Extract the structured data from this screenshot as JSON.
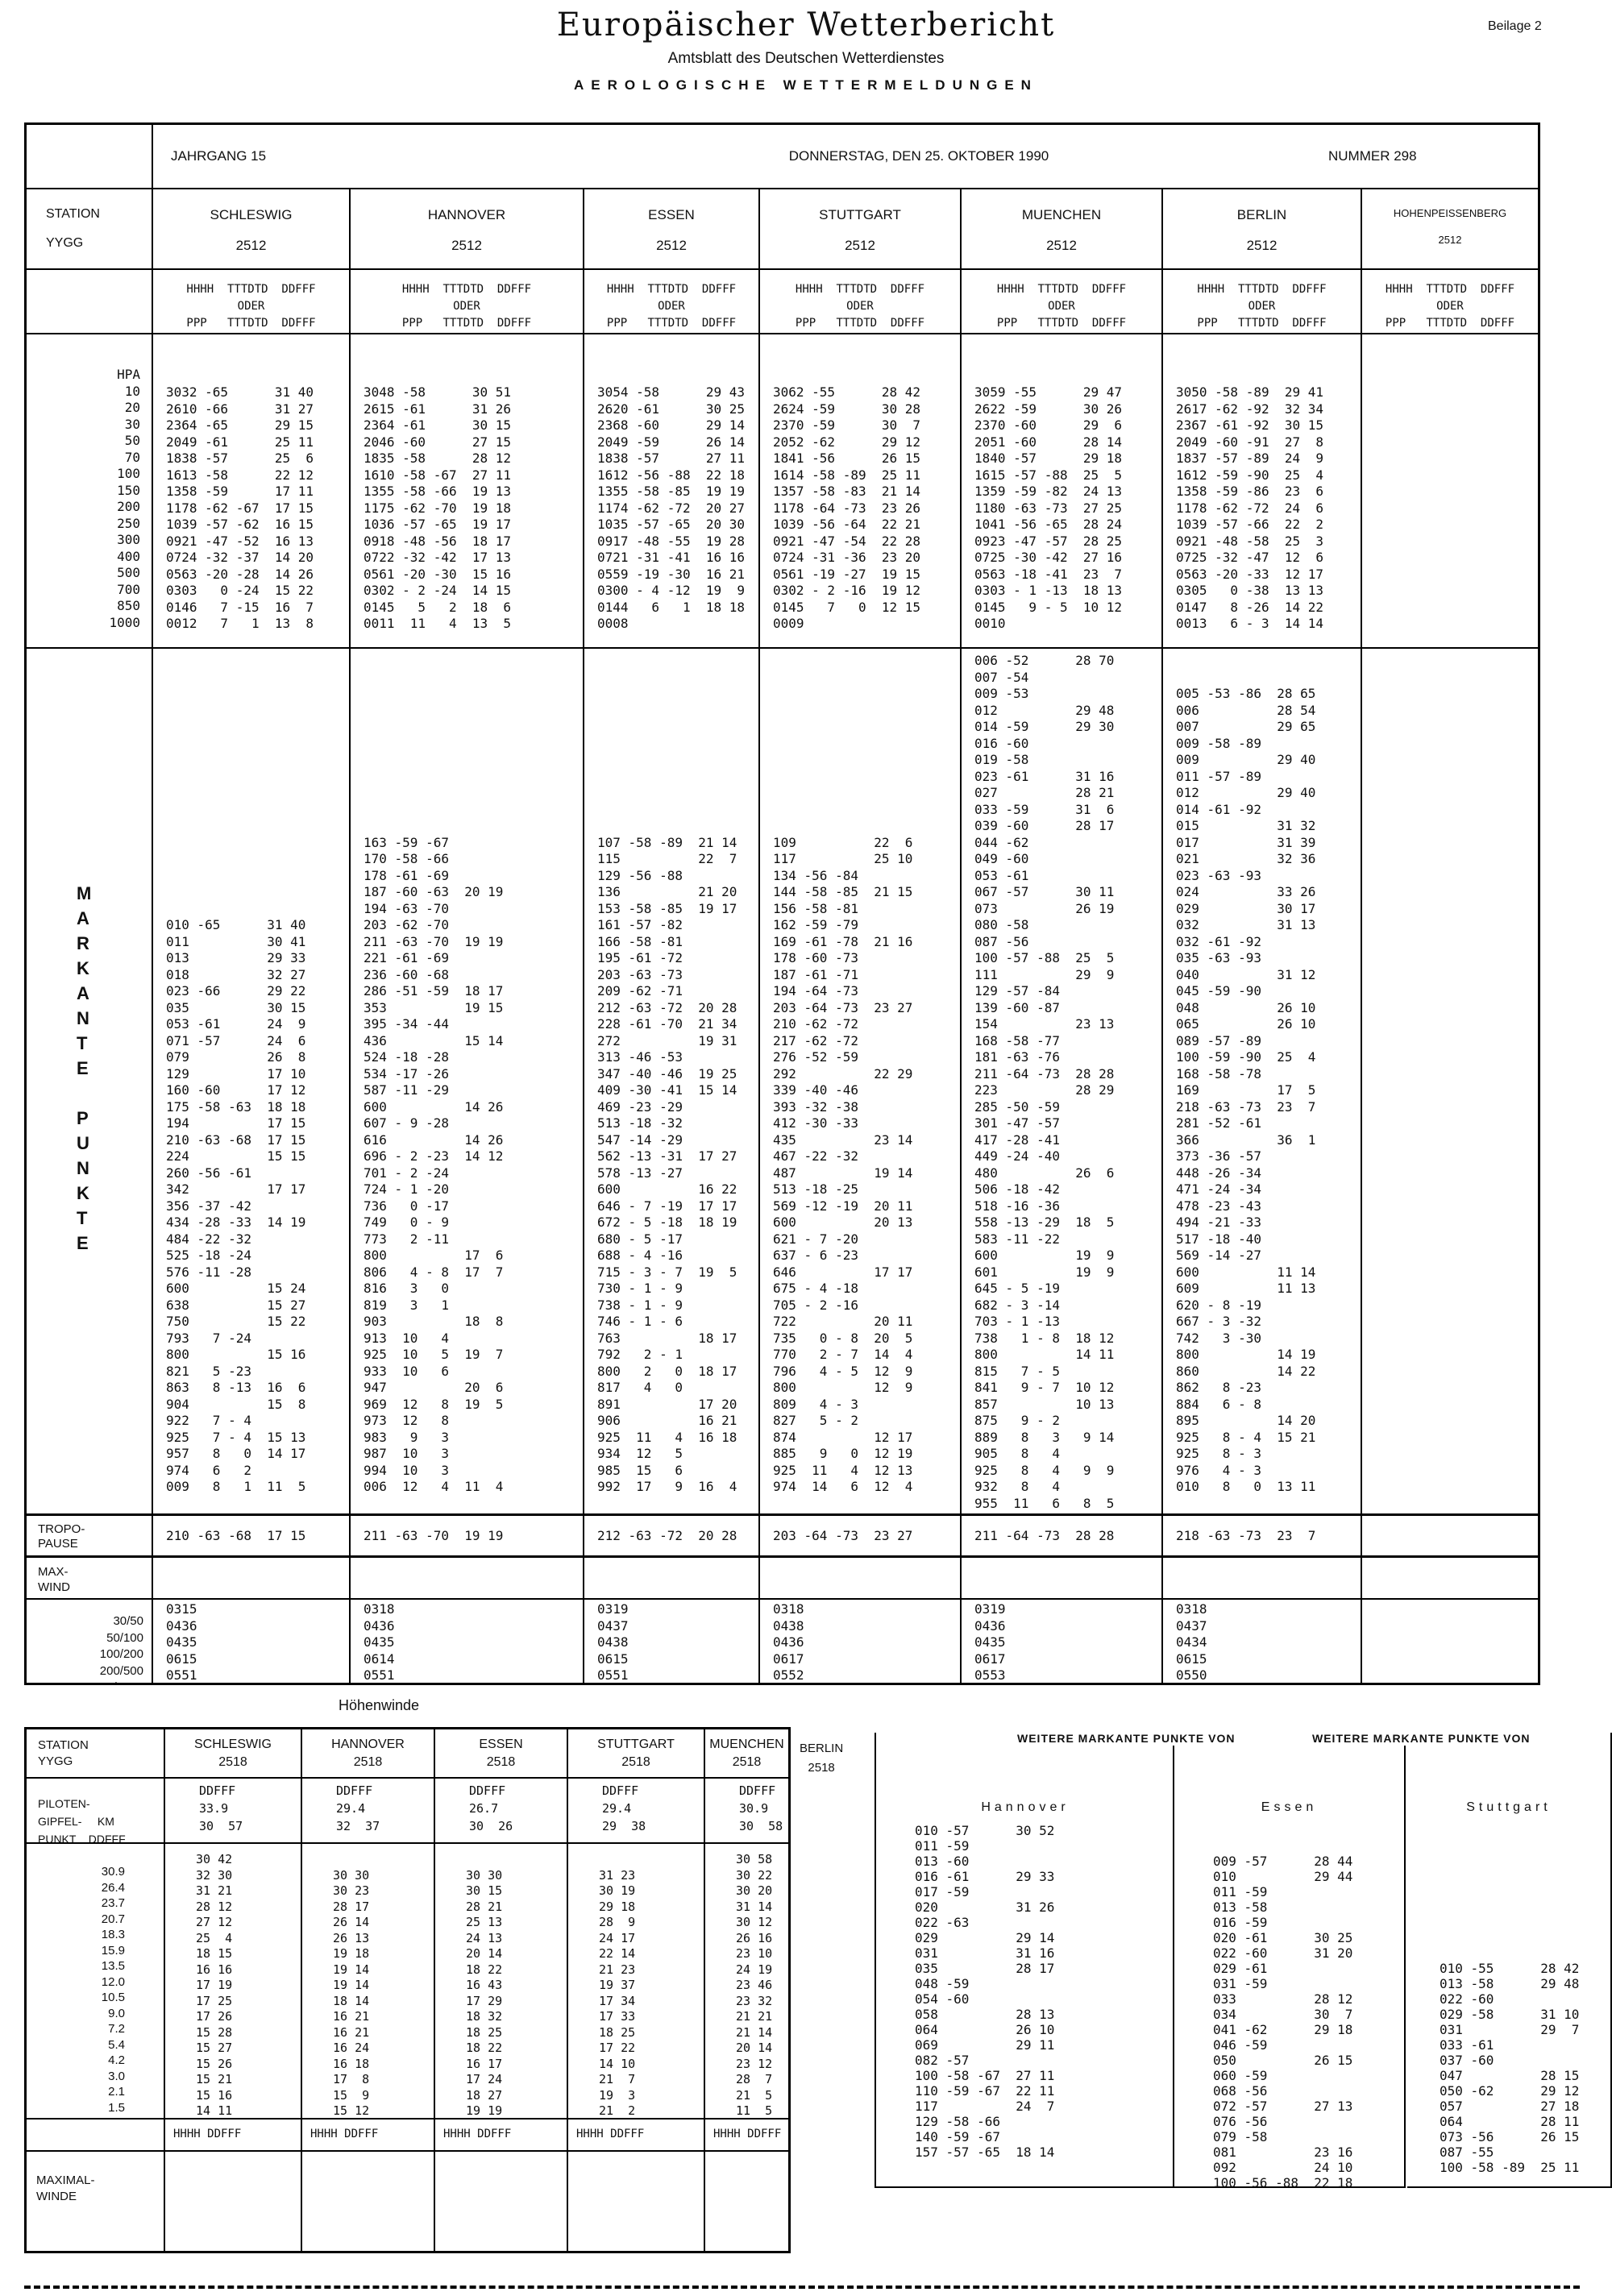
{
  "page": {
    "beilage": "Beilage 2",
    "title": "Europäischer Wetterbericht",
    "subtitle": "Amtsblatt des Deutschen Wetterdienstes",
    "tagline": "AEROLOGISCHE WETTERMELDUNGEN"
  },
  "issue": {
    "jahrgang": "JAHRGANG 15",
    "date": "DONNERSTAG, DEN 25. OKTOBER 1990",
    "nummer": "NUMMER 298"
  },
  "main_table": {
    "station_label": "STATION",
    "yygg_label": "YYGG",
    "hpa_label": "HPA",
    "codes": [
      "HHHH  TTTDTD  DDFFF",
      "ODER",
      "PPP   TTTDTD  DDFFF"
    ],
    "pressures": [
      "10",
      "20",
      "30",
      "50",
      "70",
      "100",
      "150",
      "200",
      "250",
      "300",
      "400",
      "500",
      "700",
      "850",
      "1000"
    ],
    "markante_label": [
      "M",
      "A",
      "R",
      "K",
      "A",
      "N",
      "T",
      "E",
      "",
      "P",
      "U",
      "N",
      "K",
      "T",
      "E"
    ],
    "tropo_label": [
      "TROPO-",
      "PAUSE"
    ],
    "maxwind_label": [
      "MAX-",
      "WIND"
    ],
    "maxwind_layers": [
      "30/50",
      "50/100",
      "100/200",
      "200/500",
      "500/1000"
    ],
    "stations": [
      {
        "name": "SCHLESWIG",
        "yygg": "2512",
        "hpa": [
          "3032 -65      31 40",
          "2610 -66      31 27",
          "2364 -65      29 15",
          "2049 -61      25 11",
          "1838 -57      25  6",
          "1613 -58      22 12",
          "1358 -59      17 11",
          "1178 -62 -67  17 15",
          "1039 -57 -62  16 15",
          "0921 -47 -52  16 13",
          "0724 -32 -37  14 20",
          "0563 -20 -28  14 26",
          "0303   0 -24  15 22",
          "0146   7 -15  16  7",
          "0012   7   1  13  8"
        ],
        "markante": [
          "",
          "",
          "",
          "",
          "",
          "",
          "",
          "",
          "",
          "",
          "",
          "",
          "",
          "",
          "",
          "",
          "010 -65      31 40",
          "011          30 41",
          "013          29 33",
          "018          32 27",
          "023 -66      29 22",
          "035          30 15",
          "053 -61      24  9",
          "071 -57      24  6",
          "079          26  8",
          "129          17 10",
          "160 -60      17 12",
          "175 -58 -63  18 18",
          "194          17 15",
          "210 -63 -68  17 15",
          "224          15 15",
          "260 -56 -61",
          "342          17 17",
          "356 -37 -42",
          "434 -28 -33  14 19",
          "484 -22 -32",
          "525 -18 -24",
          "576 -11 -28",
          "600          15 24",
          "638          15 27",
          "750          15 22",
          "793   7 -24",
          "800          15 16",
          "821   5 -23",
          "863   8 -13  16  6",
          "904          15  8",
          "922   7 - 4",
          "925   7 - 4  15 13",
          "957   8   0  14 17",
          "974   6   2",
          "009   8   1  11  5"
        ],
        "tropopause": "210 -63 -68  17 15",
        "maxwind": [
          "0315",
          "0436",
          "0435",
          "0615",
          "0551"
        ]
      },
      {
        "name": "HANNOVER",
        "yygg": "2512",
        "hpa": [
          "3048 -58      30 51",
          "2615 -61      31 26",
          "2364 -61      30 15",
          "2046 -60      27 15",
          "1835 -58      28 12",
          "1610 -58 -67  27 11",
          "1355 -58 -66  19 13",
          "1175 -62 -70  19 18",
          "1036 -57 -65  19 17",
          "0918 -48 -56  18 17",
          "0722 -32 -42  17 13",
          "0561 -20 -30  15 16",
          "0302 - 2 -24  14 15",
          "0145   5   2  18  6",
          "0011  11   4  13  5"
        ],
        "markante": [
          "",
          "",
          "",
          "",
          "",
          "",
          "",
          "",
          "",
          "",
          "",
          "163 -59 -67",
          "170 -58 -66",
          "178 -61 -69",
          "187 -60 -63  20 19",
          "194 -63 -70",
          "203 -62 -70",
          "211 -63 -70  19 19",
          "221 -61 -69",
          "236 -60 -68",
          "286 -51 -59  18 17",
          "353          19 15",
          "395 -34 -44",
          "436          15 14",
          "524 -18 -28",
          "534 -17 -26",
          "587 -11 -29",
          "600          14 26",
          "607 - 9 -28",
          "616          14 26",
          "696 - 2 -23  14 12",
          "701 - 2 -24",
          "724 - 1 -20",
          "736   0 -17",
          "749   0 - 9",
          "773   2 -11",
          "800          17  6",
          "806   4 - 8  17  7",
          "816   3   0",
          "819   3   1",
          "903          18  8",
          "913  10   4",
          "925  10   5  19  7",
          "933  10   6",
          "947          20  6",
          "969  12   8  19  5",
          "973  12   8",
          "983   9   3",
          "987  10   3",
          "994  10   3",
          "006  12   4  11  4"
        ],
        "tropopause": "211 -63 -70  19 19",
        "maxwind": [
          "0318",
          "0436",
          "0435",
          "0614",
          "0551"
        ]
      },
      {
        "name": "ESSEN",
        "yygg": "2512",
        "hpa": [
          "3054 -58      29 43",
          "2620 -61      30 25",
          "2368 -60      29 14",
          "2049 -59      26 14",
          "1838 -57      27 11",
          "1612 -56 -88  22 18",
          "1355 -58 -85  19 19",
          "1174 -62 -72  20 27",
          "1035 -57 -65  20 30",
          "0917 -48 -55  19 28",
          "0721 -31 -41  16 16",
          "0559 -19 -30  16 21",
          "0300 - 4 -12  19  9",
          "0144   6   1  18 18",
          "0008"
        ],
        "markante": [
          "",
          "",
          "",
          "",
          "",
          "",
          "",
          "",
          "",
          "",
          "",
          "107 -58 -89  21 14",
          "115          22  7",
          "129 -56 -88",
          "136          21 20",
          "153 -58 -85  19 17",
          "161 -57 -82",
          "166 -58 -81",
          "195 -61 -72",
          "203 -63 -73",
          "209 -62 -71",
          "212 -63 -72  20 28",
          "228 -61 -70  21 34",
          "272          19 31",
          "313 -46 -53",
          "347 -40 -46  19 25",
          "409 -30 -41  15 14",
          "469 -23 -29",
          "513 -18 -32",
          "547 -14 -29",
          "562 -13 -31  17 27",
          "578 -13 -27",
          "600          16 22",
          "646 - 7 -19  17 17",
          "672 - 5 -18  18 19",
          "680 - 5 -17",
          "688 - 4 -16",
          "715 - 3 - 7  19  5",
          "730 - 1 - 9",
          "738 - 1 - 9",
          "746 - 1 - 6",
          "763          18 17",
          "792   2 - 1",
          "800   2   0  18 17",
          "817   4   0",
          "891          17 20",
          "906          16 21",
          "925  11   4  16 18",
          "934  12   5",
          "985  15   6",
          "992  17   9  16  4"
        ],
        "tropopause": "212 -63 -72  20 28",
        "maxwind": [
          "0319",
          "0437",
          "0438",
          "0615",
          "0551"
        ]
      },
      {
        "name": "STUTTGART",
        "yygg": "2512",
        "hpa": [
          "3062 -55      28 42",
          "2624 -59      30 28",
          "2370 -59      30  7",
          "2052 -62      29 12",
          "1841 -56      26 15",
          "1614 -58 -89  25 11",
          "1357 -58 -83  21 14",
          "1178 -64 -73  23 26",
          "1039 -56 -64  22 21",
          "0921 -47 -54  22 28",
          "0724 -31 -36  23 20",
          "0561 -19 -27  19 15",
          "0302 - 2 -16  19 12",
          "0145   7   0  12 15",
          "0009"
        ],
        "markante": [
          "",
          "",
          "",
          "",
          "",
          "",
          "",
          "",
          "",
          "",
          "",
          "109          22  6",
          "117          25 10",
          "134 -56 -84",
          "144 -58 -85  21 15",
          "156 -58 -81",
          "162 -59 -79",
          "169 -61 -78  21 16",
          "178 -60 -73",
          "187 -61 -71",
          "194 -64 -73",
          "203 -64 -73  23 27",
          "210 -62 -72",
          "217 -62 -72",
          "276 -52 -59",
          "292          22 29",
          "339 -40 -46",
          "393 -32 -38",
          "412 -30 -33",
          "435          23 14",
          "467 -22 -32",
          "487          19 14",
          "513 -18 -25",
          "569 -12 -19  20 11",
          "600          20 13",
          "621 - 7 -20",
          "637 - 6 -23",
          "646          17 17",
          "675 - 4 -18",
          "705 - 2 -16",
          "722          20 11",
          "735   0 - 8  20  5",
          "770   2 - 7  14  4",
          "796   4 - 5  12  9",
          "800          12  9",
          "809   4 - 3",
          "827   5 - 2",
          "874          12 17",
          "885   9   0  12 19",
          "925  11   4  12 13",
          "974  14   6  12  4"
        ],
        "tropopause": "203 -64 -73  23 27",
        "maxwind": [
          "0318",
          "0438",
          "0436",
          "0617",
          "0552"
        ]
      },
      {
        "name": "MUENCHEN",
        "yygg": "2512",
        "hpa": [
          "3059 -55      29 47",
          "2622 -59      30 26",
          "2370 -60      29  6",
          "2051 -60      28 14",
          "1840 -57      29 18",
          "1615 -57 -88  25  5",
          "1359 -59 -82  24 13",
          "1180 -63 -73  27 25",
          "1041 -56 -65  28 24",
          "0923 -47 -57  28 25",
          "0725 -30 -42  27 16",
          "0563 -18 -41  23  7",
          "0303 - 1 -13  18 13",
          "0145   9 - 5  10 12",
          "0010"
        ],
        "markante": [
          "006 -52      28 70",
          "007 -54",
          "009 -53",
          "012          29 48",
          "014 -59      29 30",
          "016 -60",
          "019 -58",
          "023 -61      31 16",
          "027          28 21",
          "033 -59      31  6",
          "039 -60      28 17",
          "044 -62",
          "049 -60",
          "053 -61",
          "067 -57      30 11",
          "073          26 19",
          "080 -58",
          "087 -56",
          "100 -57 -88  25  5",
          "111          29  9",
          "129 -57 -84",
          "139 -60 -87",
          "154          23 13",
          "168 -58 -77",
          "181 -63 -76",
          "211 -64 -73  28 28",
          "223          28 29",
          "285 -50 -59",
          "301 -47 -57",
          "417 -28 -41",
          "449 -24 -40",
          "480          26  6",
          "506 -18 -42",
          "518 -16 -36",
          "558 -13 -29  18  5",
          "583 -11 -22",
          "600          19  9",
          "601          19  9",
          "645 - 5 -19",
          "682 - 3 -14",
          "703 - 1 -13",
          "738   1 - 8  18 12",
          "800          14 11",
          "815   7 - 5",
          "841   9 - 7  10 12",
          "857          10 13",
          "875   9 - 2",
          "889   8   3   9 14",
          "905   8   4",
          "925   8   4   9  9",
          "932   8   4",
          "955  11   6   8  5"
        ],
        "tropopause": "211 -64 -73  28 28",
        "maxwind": [
          "0319",
          "0436",
          "0435",
          "0617",
          "0553"
        ]
      },
      {
        "name": "BERLIN",
        "yygg": "2512",
        "hpa": [
          "3050 -58 -89  29 41",
          "2617 -62 -92  32 34",
          "2367 -61 -92  30 15",
          "2049 -60 -91  27  8",
          "1837 -57 -89  24  9",
          "1612 -59 -90  25  4",
          "1358 -59 -86  23  6",
          "1178 -62 -72  24  6",
          "1039 -57 -66  22  2",
          "0921 -48 -58  25  3",
          "0725 -32 -47  12  6",
          "0563 -20 -33  12 17",
          "0305   0 -38  13 13",
          "0147   8 -26  14 22",
          "0013   6 - 3  14 14"
        ],
        "markante": [
          "",
          "",
          "005 -53 -86  28 65",
          "006          28 54",
          "007          29 65",
          "009 -58 -89",
          "009          29 40",
          "011 -57 -89",
          "012          29 40",
          "014 -61 -92",
          "015          31 32",
          "017          31 39",
          "021          32 36",
          "023 -63 -93",
          "024          33 26",
          "029          30 17",
          "032          31 13",
          "032 -61 -92",
          "035 -63 -93",
          "040          31 12",
          "045 -59 -90",
          "048          26 10",
          "065          26 10",
          "089 -57 -89",
          "100 -59 -90  25  4",
          "168 -58 -78",
          "169          17  5",
          "218 -63 -73  23  7",
          "281 -52 -61",
          "366          36  1",
          "373 -36 -57",
          "448 -26 -34",
          "471 -24 -34",
          "478 -23 -43",
          "494 -21 -33",
          "517 -18 -40",
          "569 -14 -27",
          "600          11 14",
          "609          11 13",
          "620 - 8 -19",
          "667 - 3 -32",
          "742   3 -30",
          "800          14 19",
          "860          14 22",
          "862   8 -23",
          "884   6 - 8",
          "895          14 20",
          "925   8 - 4  15 21",
          "925   8 - 3",
          "976   4 - 3",
          "010   8   0  13 11"
        ],
        "tropopause": "218 -63 -73  23  7",
        "maxwind": [
          "0318",
          "0437",
          "0434",
          "0615",
          "0550"
        ]
      },
      {
        "name": "HOHENPEISSENBERG",
        "yygg": "2512",
        "hpa": [],
        "markante": [],
        "tropopause": "",
        "maxwind": []
      }
    ]
  },
  "hoehenwinde": {
    "heading": "Höhenwinde",
    "station_label": "STATION",
    "yygg_label": "YYGG",
    "gipfel_label": [
      "PILOTEN-",
      "GIPFEL-     KM",
      "PUNKT    DDFFF"
    ],
    "codes_cell": "HHHH    DDFFF",
    "maxwinde_label": [
      "MAXIMAL-",
      "WINDE"
    ],
    "km": [
      "30.9",
      "26.4",
      "23.7",
      "20.7",
      "18.3",
      "15.9",
      "13.5",
      "12.0",
      "10.5",
      "9.0",
      "7.2",
      "5.4",
      "4.2",
      "3.0",
      "2.1",
      "1.5",
      "0.9"
    ],
    "berlin_extra": {
      "name": "BERLIN",
      "yygg": "2518"
    },
    "stations": [
      {
        "name": "SCHLESWIG",
        "yygg": "2518",
        "gipfel": [
          "DDFFF",
          "33.9",
          "30  57"
        ],
        "winds": [
          "30 42",
          "32 30",
          "31 21",
          "28 12",
          "27 12",
          "25  4",
          "18 15",
          "16 16",
          "17 19",
          "17 25",
          "17 26",
          "15 28",
          "15 27",
          "15 26",
          "15 21",
          "15 16",
          "14 11"
        ]
      },
      {
        "name": "HANNOVER",
        "yygg": "2518",
        "gipfel": [
          "DDFFF",
          "29.4",
          "32  37"
        ],
        "winds": [
          "",
          "30 30",
          "30 23",
          "28 17",
          "26 14",
          "26 13",
          "19 18",
          "19 14",
          "19 14",
          "18 14",
          "16 21",
          "16 21",
          "16 24",
          "16 18",
          "17  8",
          "15  9",
          "15 12"
        ]
      },
      {
        "name": "ESSEN",
        "yygg": "2518",
        "gipfel": [
          "DDFFF",
          "26.7",
          "30  26"
        ],
        "winds": [
          "",
          "30 30",
          "30 15",
          "28 21",
          "25 13",
          "24 13",
          "20 14",
          "18 22",
          "16 43",
          "17 29",
          "18 32",
          "18 25",
          "18 22",
          "16 17",
          "17 24",
          "18 27",
          "19 19"
        ]
      },
      {
        "name": "STUTTGART",
        "yygg": "2518",
        "gipfel": [
          "DDFFF",
          "29.4",
          "29  38"
        ],
        "winds": [
          "",
          "31 23",
          "30 19",
          "29 18",
          "28  9",
          "24 17",
          "22 14",
          "21 23",
          "19 37",
          "17 34",
          "17 33",
          "18 25",
          "17 22",
          "14 10",
          "21  7",
          "19  3",
          "21  2"
        ]
      },
      {
        "name": "MUENCHEN",
        "yygg": "2518",
        "gipfel": [
          "DDFFF",
          "30.9",
          "30  58"
        ],
        "winds": [
          "30 58",
          "30 22",
          "30 20",
          "31 14",
          "30 12",
          "26 16",
          "23 10",
          "24 19",
          "23 46",
          "23 32",
          "21 21",
          "21 14",
          "20 14",
          "23 12",
          "28  7",
          "21  5",
          "11  5"
        ]
      }
    ]
  },
  "weitere": {
    "heading_left": "WEITERE MARKANTE PUNKTE VON",
    "heading_right": "WEITERE MARKANTE PUNKTE VON",
    "columns": [
      {
        "name": "Hannover",
        "lines": [
          "010 -57      30 52",
          "011 -59",
          "013 -60",
          "016 -61      29 33",
          "017 -59",
          "020          31 26",
          "022 -63",
          "029          29 14",
          "031          31 16",
          "035          28 17",
          "048 -59",
          "054 -60",
          "058          28 13",
          "064          26 10",
          "069          29 11",
          "082 -57",
          "100 -58 -67  27 11",
          "110 -59 -67  22 11",
          "117          24  7",
          "129 -58 -66",
          "140 -59 -67",
          "157 -57 -65  18 14"
        ]
      },
      {
        "name": "Essen",
        "lines": [
          "",
          "",
          "009 -57      28 44",
          "010          29 44",
          "011 -59",
          "013 -58",
          "016 -59",
          "020 -61      30 25",
          "022 -60      31 20",
          "029 -61",
          "031 -59",
          "033          28 12",
          "034          30  7",
          "041 -62      29 18",
          "046 -59",
          "050          26 15",
          "060 -59",
          "068 -56",
          "072 -57      27 13",
          "076 -56",
          "079 -58",
          "081          23 16",
          "092          24 10",
          "100 -56 -88  22 18"
        ]
      },
      {
        "name": "Stuttgart",
        "lines": [
          "",
          "",
          "",
          "",
          "",
          "",
          "",
          "",
          "",
          "010 -55      28 42",
          "013 -58      29 48",
          "022 -60",
          "029 -58      31 10",
          "031          29  7",
          "033 -61",
          "037 -60",
          "047          28 15",
          "050 -62      29 12",
          "057          27 18",
          "064          28 11",
          "073 -56      26 15",
          "087 -55",
          "100 -58 -89  25 11"
        ]
      }
    ]
  }
}
